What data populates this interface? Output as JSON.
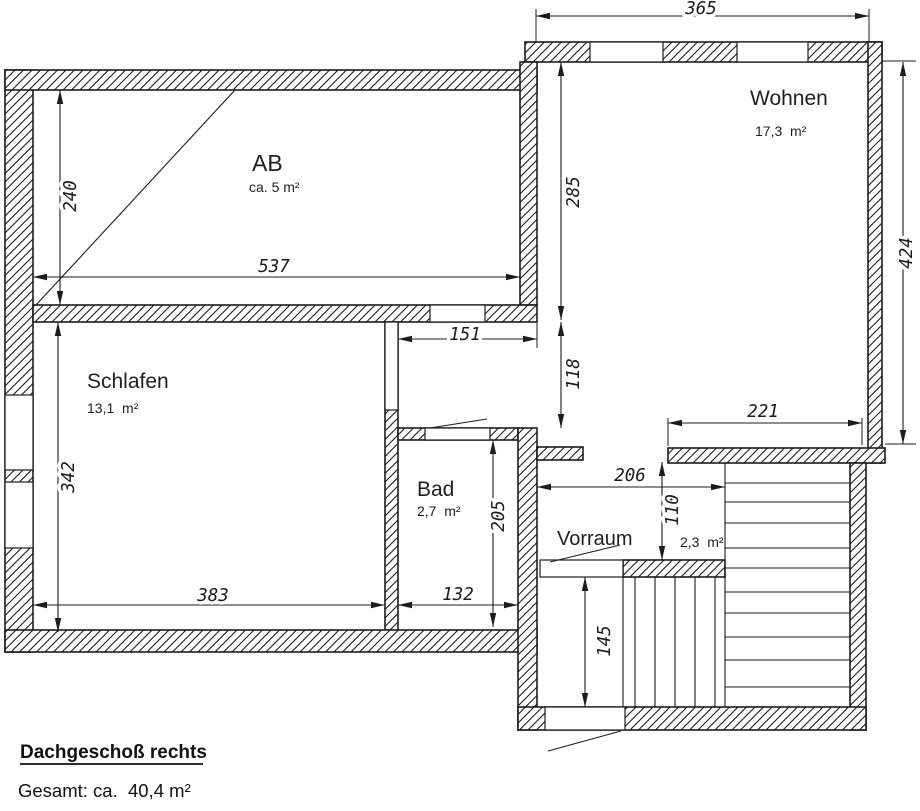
{
  "plan": {
    "rooms": {
      "ab": {
        "name": "AB",
        "area": "ca. 5 m²"
      },
      "wohnen": {
        "name": "Wohnen",
        "area": "17,3  m²"
      },
      "schlafen": {
        "name": "Schlafen",
        "area": "13,1  m²"
      },
      "bad": {
        "name": "Bad",
        "area": "2,7  m²"
      },
      "vorraum": {
        "name": "Vorraum",
        "area": "2,3  m²"
      }
    },
    "dims": {
      "total_width": "365",
      "ab_height": "240",
      "ab_width": "537",
      "wohnen_height_inner": "285",
      "wohnen_height": "424",
      "corridor_width": "151",
      "corridor_height": "118",
      "wohnen_bottom": "221",
      "schlafen_height": "342",
      "schlafen_width": "383",
      "bad_height": "205",
      "bad_width": "132",
      "vorraum_width": "206",
      "vorraum_height": "110",
      "stair_landing": "145"
    },
    "footer": {
      "heading": "Dachgeschoß rechts",
      "total": "Gesamt: ca.  40,4 m²"
    },
    "line_color": "#1c1c1c"
  }
}
